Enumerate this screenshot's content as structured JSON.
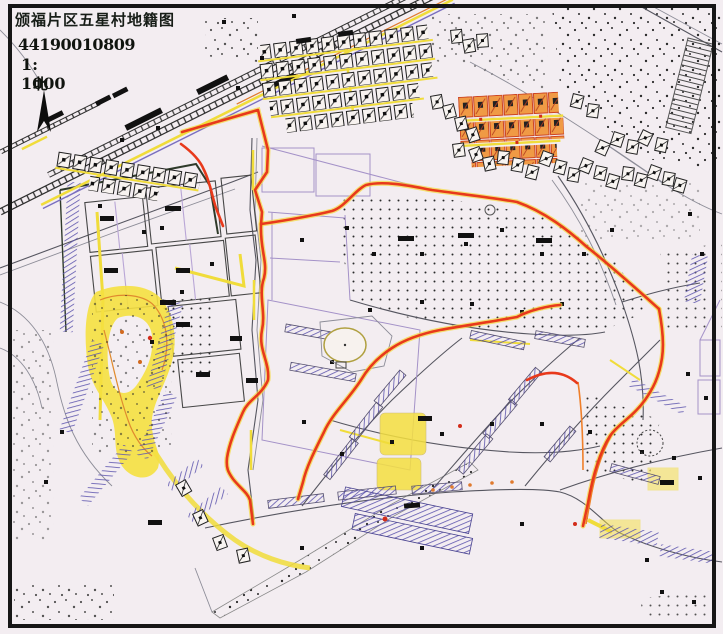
{
  "sheet": {
    "title": "颁福片区五星村地籍图",
    "sheet_number": "44190010809",
    "scale": "1: 1000",
    "north_label": "北"
  },
  "palette": {
    "paper": "#f3edf1",
    "frame_black": "#161616",
    "boundary_red": "#e8391b",
    "boundary_glow_yellow": "#f3d93a",
    "road_yellow": "#f0dc3a",
    "slope_hatch_blue": "#5d55ae",
    "parcel_purple": "#a492c8",
    "contour_orange": "#e08a2e",
    "building_orange": "#f09a45",
    "line_dark": "#3c3c3c",
    "stipple_dot": "#2b2b2b"
  }
}
